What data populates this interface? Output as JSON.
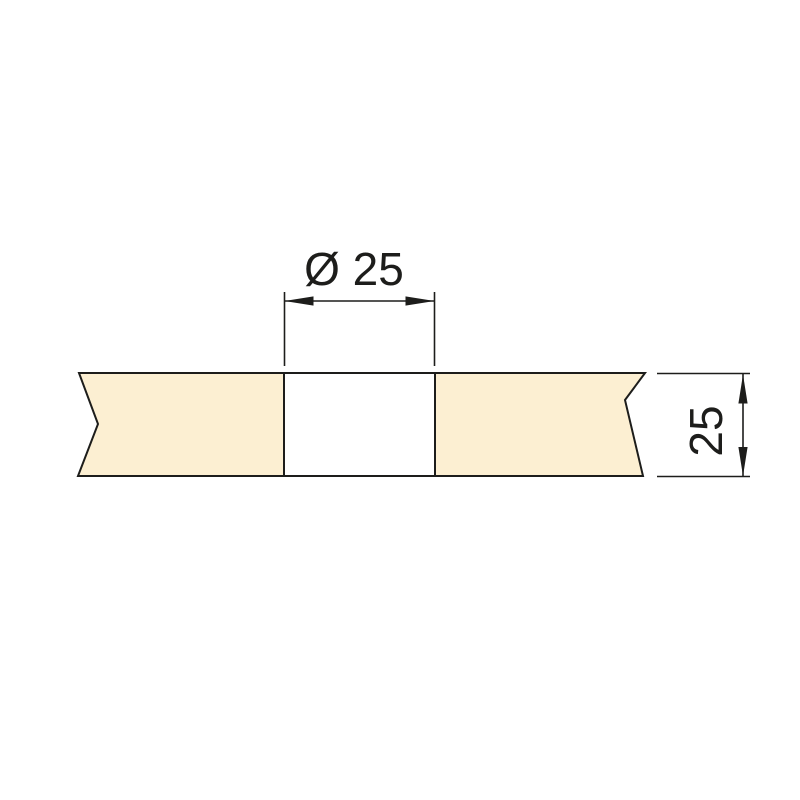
{
  "diagram": {
    "kind": "technical-drawing",
    "description": "Cross-section of a panel with a through hole, shown with break lines at both ends",
    "labels": {
      "hole_diameter": "Ø 25",
      "panel_thickness": "25"
    },
    "values": {
      "hole_diameter": 25,
      "panel_thickness": 25
    },
    "colors": {
      "panel_fill": "#FCEFD2",
      "line": "#1D1D1B",
      "background": "#FFFFFF"
    }
  }
}
